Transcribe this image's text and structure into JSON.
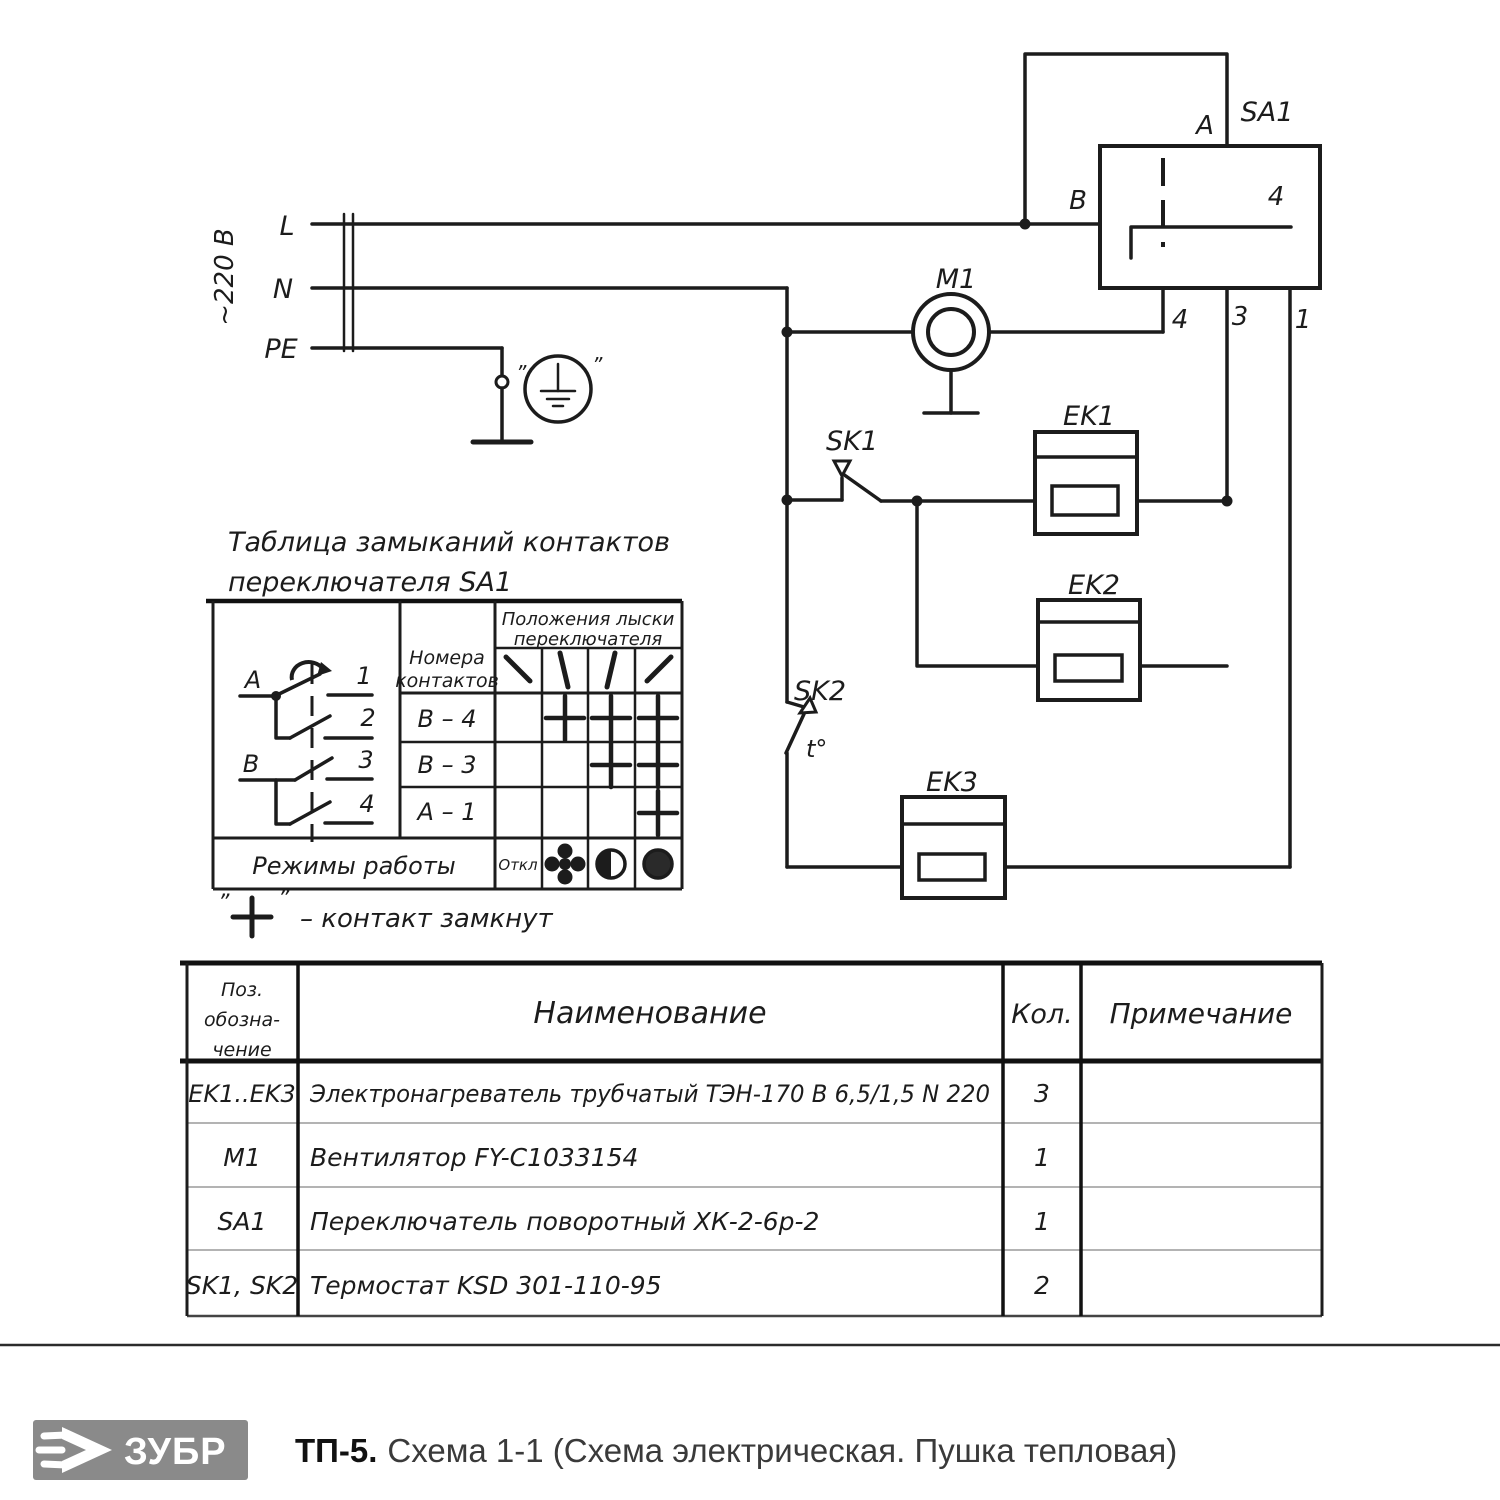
{
  "schematic": {
    "power": {
      "voltage": "~220 В",
      "line_l": "L",
      "line_n": "N",
      "line_pe": "PE"
    },
    "ground": {
      "quote_left": "”",
      "quote_right": "”"
    },
    "switch_sa1": {
      "label": "SA1",
      "terminal_a": "A",
      "terminal_b": "B",
      "inner_contact": "4",
      "terminal_4": "4",
      "terminal_3": "3",
      "terminal_1": "1"
    },
    "motor": {
      "label": "M1"
    },
    "thermostat_sk1": {
      "label": "SK1"
    },
    "thermostat_sk2": {
      "label": "SK2",
      "temp": "t°"
    },
    "heater_ek1": {
      "label": "EK1"
    },
    "heater_ek2": {
      "label": "EK2"
    },
    "heater_ek3": {
      "label": "EK3"
    }
  },
  "contact_table": {
    "title_line1": "Таблица замыканий контактов",
    "title_line2": "переключателя SA1",
    "col_contacts_line1": "Номера",
    "col_contacts_line2": "контактов",
    "col_positions_line1": "Положения лыски",
    "col_positions_line2": "переключателя",
    "rows": [
      {
        "contacts": "В – 4"
      },
      {
        "contacts": "В – 3"
      },
      {
        "contacts": "А – 1"
      }
    ],
    "closures": [
      [
        0,
        1,
        1,
        1
      ],
      [
        0,
        0,
        1,
        1
      ],
      [
        0,
        0,
        0,
        1
      ]
    ],
    "modes_label": "Режимы работы",
    "mode_off": "Откл",
    "diagram": {
      "pole_a": "A",
      "pole_b": "В",
      "c1": "1",
      "c2": "2",
      "c3": "3",
      "c4": "4"
    },
    "legend_quote_left": "”",
    "legend_quote_right": "”",
    "legend_text": "– контакт замкнут"
  },
  "parts_table": {
    "headers": {
      "pos_line1": "Поз.",
      "pos_line2": "обозна-",
      "pos_line3": "чение",
      "name": "Наименование",
      "qty": "Кол.",
      "note": "Примечание"
    },
    "rows": [
      {
        "ref": "EK1..EK3",
        "name": "Электронагреватель трубчатый ТЭН-170 В 6,5/1,5 N 220",
        "qty": "3",
        "note": ""
      },
      {
        "ref": "M1",
        "name": "Вентилятор FY-C1033154",
        "qty": "1",
        "note": ""
      },
      {
        "ref": "SA1",
        "name": "Переключатель поворотный ХК-2-6р-2",
        "qty": "1",
        "note": ""
      },
      {
        "ref": "SK1, SK2",
        "name": "Термостат KSD 301-110-95",
        "qty": "2",
        "note": ""
      }
    ]
  },
  "footer": {
    "brand": "ЗУБР",
    "model": "ТП-5.",
    "description": "Схема 1-1 (Схема электрическая. Пушка тепловая)"
  },
  "colors": {
    "ink": "#1c1c1c",
    "light_line": "#9a9a9a",
    "logo_gray": "#8a8a8a"
  }
}
